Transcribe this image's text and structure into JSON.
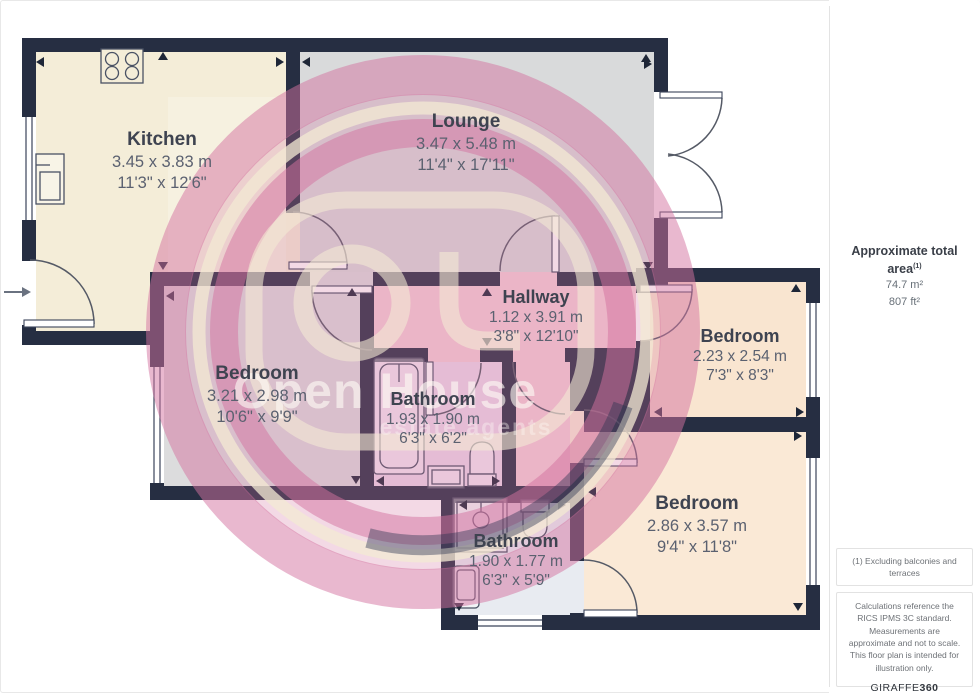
{
  "plan": {
    "rooms": [
      {
        "id": "kitchen",
        "name": "Kitchen",
        "metric": "3.45 x 3.83 m",
        "imperial": "11'3\" x 12'6\""
      },
      {
        "id": "lounge",
        "name": "Lounge",
        "metric": "3.47 x 5.48 m",
        "imperial": "11'4\" x 17'11\""
      },
      {
        "id": "hallway",
        "name": "Hallway",
        "metric": "1.12 x 3.91 m",
        "imperial": "3'8\" x 12'10\""
      },
      {
        "id": "bedroom-left",
        "name": "Bedroom",
        "metric": "3.21 x 2.98 m",
        "imperial": "10'6\" x 9'9\""
      },
      {
        "id": "bathroom-middle",
        "name": "Bathroom",
        "metric": "1.93 x 1.90 m",
        "imperial": "6'3\" x 6'2\""
      },
      {
        "id": "bedroom-right",
        "name": "Bedroom",
        "metric": "2.23 x 2.54 m",
        "imperial": "7'3\" x 8'3\""
      },
      {
        "id": "bedroom-bottom",
        "name": "Bedroom",
        "metric": "2.86 x 3.57 m",
        "imperial": "9'4\" x 11'8\""
      },
      {
        "id": "bathroom-bottom",
        "name": "Bathroom",
        "metric": "1.90 x 1.77 m",
        "imperial": "6'3\" x 5'9\""
      }
    ],
    "watermark": {
      "line1": "Open House",
      "line2": "estate agents"
    }
  },
  "sidebar": {
    "area_title": "Approximate total area",
    "area_superscript": "(1)",
    "area_m2": "74.7 m²",
    "area_ft2": "807 ft²",
    "note_excluding": "(1) Excluding balconies and terraces",
    "disclaimer": "Calculations reference the RICS IPMS 3C standard. Measurements are approximate and not to scale. This floor plan is intended for illustration only.",
    "brand": "GIRAFFE",
    "brand_suffix": "360"
  },
  "colors": {
    "wall": "#262e42",
    "watermark_pink": "#d4729f",
    "watermark_cream": "#f3e9d3",
    "kitchen_floor": "#f4edd8",
    "lounge_floor": "#d9dadb",
    "bedroom_left_floor": "#dcdcdd",
    "hallway_floor": "#f5ced6",
    "bathroom_middle_floor": "#ecd8ea",
    "bathroom_bottom_floor": "#e8ebf1",
    "bedroom_peach_floor": "#f9e5d0"
  }
}
